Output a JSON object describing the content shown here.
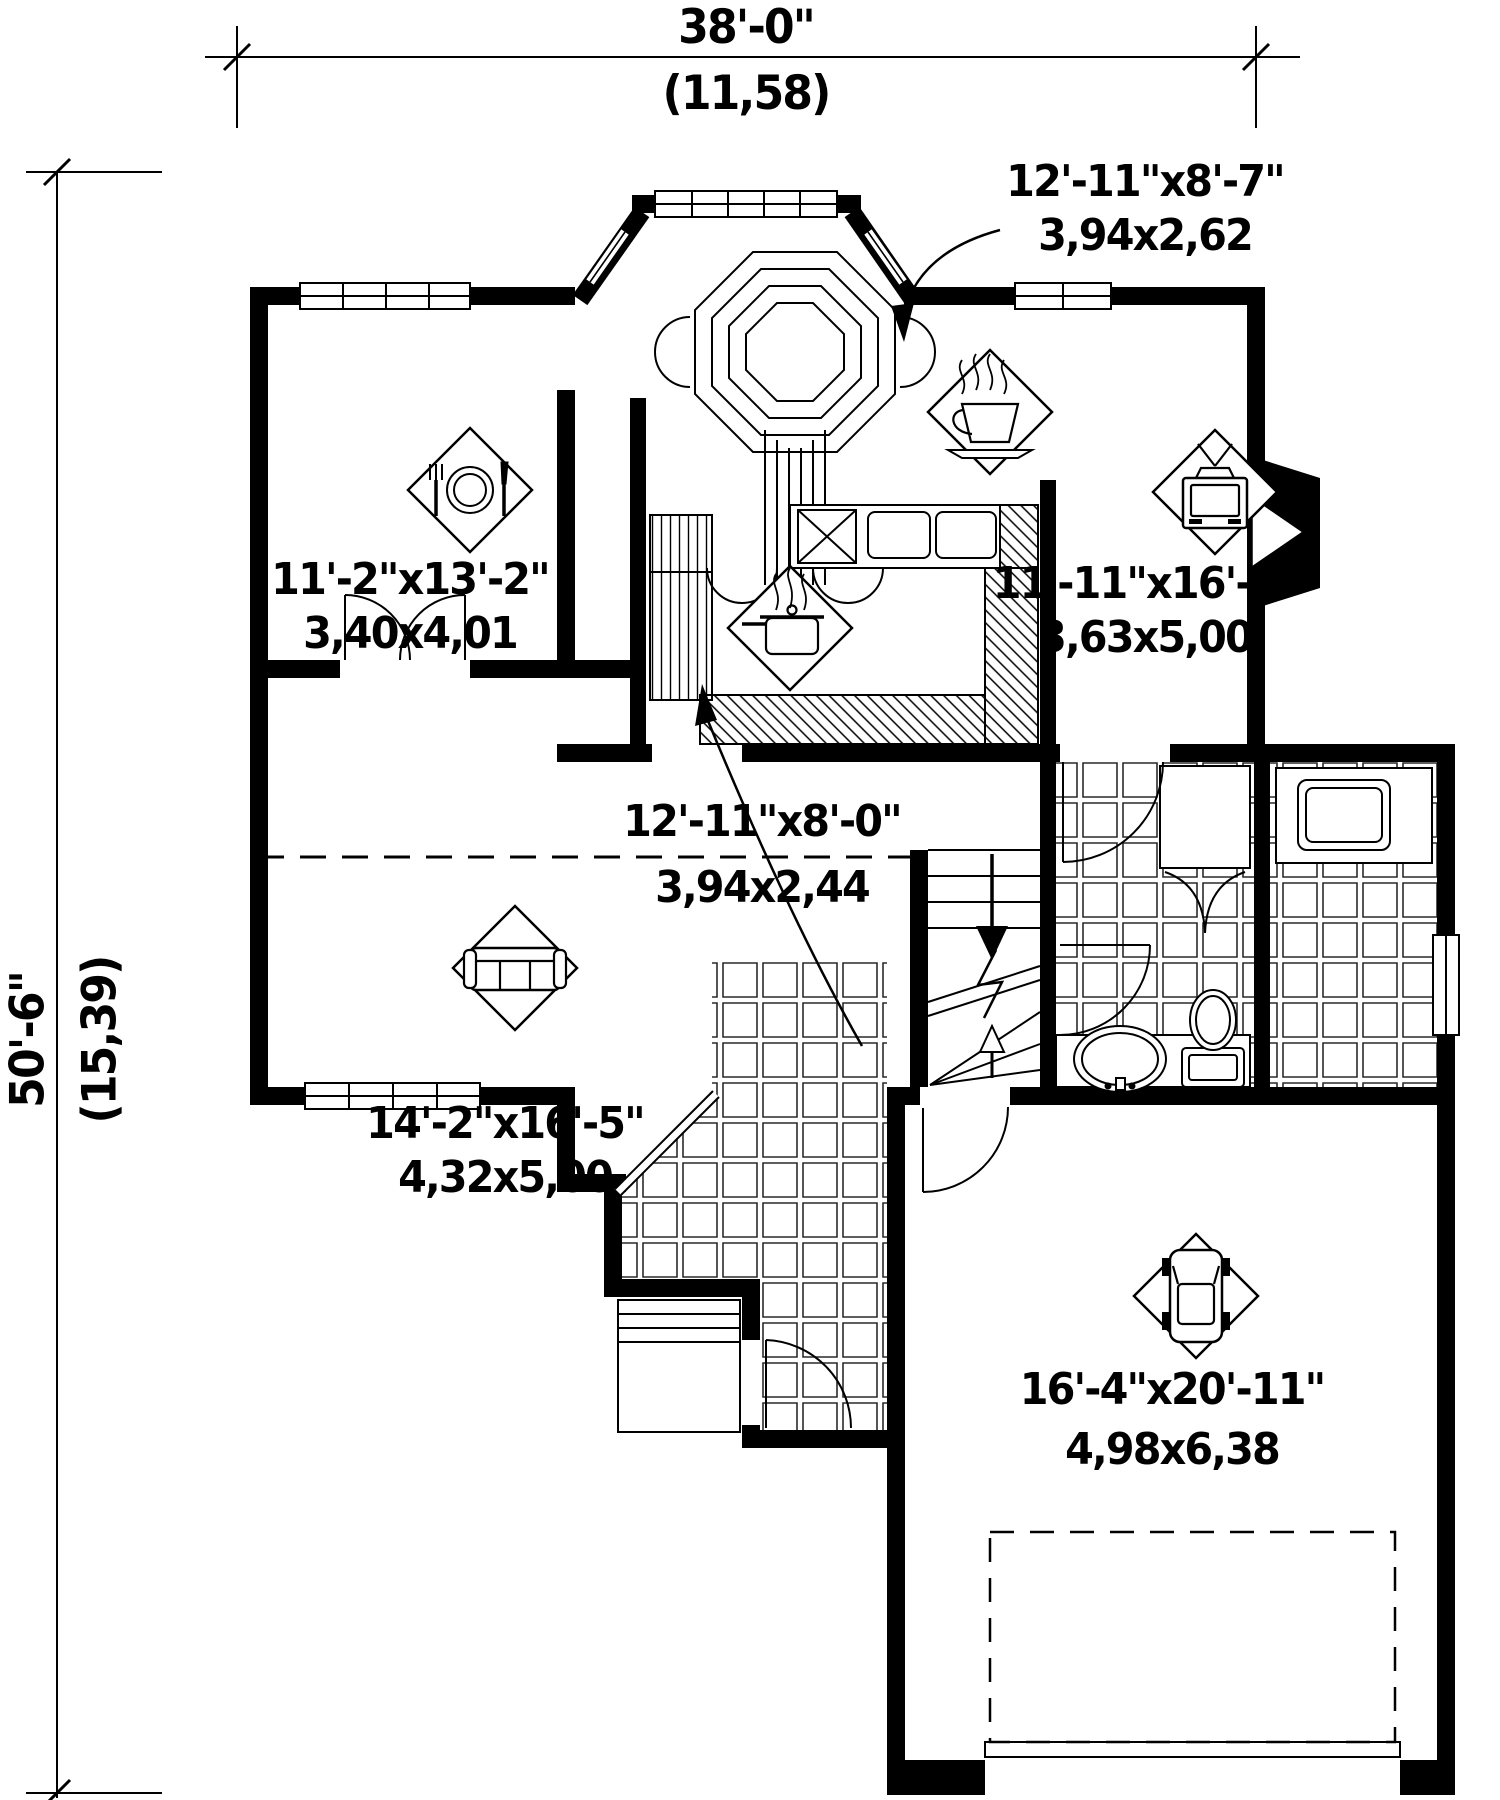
{
  "dimensions": {
    "width_ft": "38'-0\"",
    "width_m": "(11,58)",
    "depth_ft": "50'-6\"",
    "depth_m": "(15,39)"
  },
  "rooms": {
    "dinette": {
      "size_ft": "12'-11\"x8'-7\"",
      "size_m": "3,94x2,62",
      "icon": "coffee-cup"
    },
    "dining": {
      "size_ft": "11'-2\"x13'-2\"",
      "size_m": "3,40x4,01",
      "icon": "cutlery-plate"
    },
    "living": {
      "size_ft": "11'-11\"x16'-5\"",
      "size_m": "3,63x5,00",
      "icon": "tv"
    },
    "kitchen": {
      "icon": "cooking-pot"
    },
    "hall": {
      "size_ft": "12'-11\"x8'-0\"",
      "size_m": "3,94x2,44"
    },
    "family": {
      "size_ft": "14'-2\"x16'-5\"",
      "size_m": "4,32x5,00",
      "icon": "sofa"
    },
    "garage": {
      "size_ft": "16'-4\"x20'-11\"",
      "size_m": "4,98x6,38",
      "icon": "car"
    }
  },
  "colors": {
    "ink": "#000000",
    "paper": "#ffffff"
  }
}
